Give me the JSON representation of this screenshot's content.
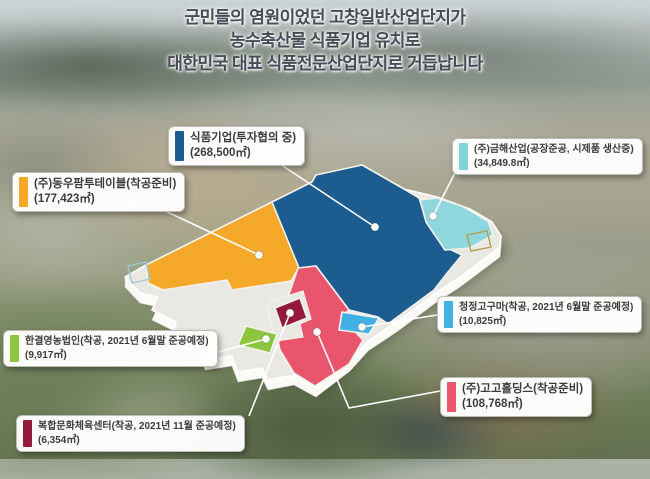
{
  "header": {
    "line1": "군민들의 염원이었던 고창일반산업단지가",
    "line2": "농수축산물 식품기업 유치로",
    "line3": "대한민국 대표 식품전문산업단지로 거듭납니다"
  },
  "colors": {
    "blue": "#1d5c8e",
    "orange": "#f6a828",
    "cyan": "#8fd6dd",
    "red": "#e9556c",
    "lightblue": "#41b1e3",
    "green": "#8cc63f",
    "maroon": "#941a3d",
    "plate": "#e9e8e3",
    "plate_side": "#fbfaf6",
    "lot_left_outline": "#9fc8d8",
    "lot_right_outline": "#b5a04b"
  },
  "callouts": [
    {
      "id": "food",
      "title": "식품기업(투자협의 중)",
      "area": "(268,500㎡)",
      "color": "#1d5c8e"
    },
    {
      "id": "geumhae",
      "title": "(주)금해산업(공장준공, 시제품 생산중)",
      "area": "(34,849.8㎡)",
      "color": "#82d2da"
    },
    {
      "id": "dongwoo",
      "title": "(주)동우팜투테이블(착공준비)",
      "area": "(177,423㎡)",
      "color": "#f6a828"
    },
    {
      "id": "hangyeol",
      "title": "한결영농법인(착공, 2021년 6월말 준공예정)",
      "area": "(9,917㎡)",
      "color": "#8cc63f"
    },
    {
      "id": "bokhap",
      "title": "복합문화체육센터(착공, 2021년 11월 준공예정)",
      "area": "(6,354㎡)",
      "color": "#941a3d"
    },
    {
      "id": "cheongjeong",
      "title": "청정고구마(착공, 2021년 6월말 준공예정)",
      "area": "(10,825㎡)",
      "color": "#41b1e3"
    },
    {
      "id": "gogo",
      "title": "(주)고고홀딩스(착공준비)",
      "area": "(108,768㎡)",
      "color": "#e9556c"
    }
  ]
}
